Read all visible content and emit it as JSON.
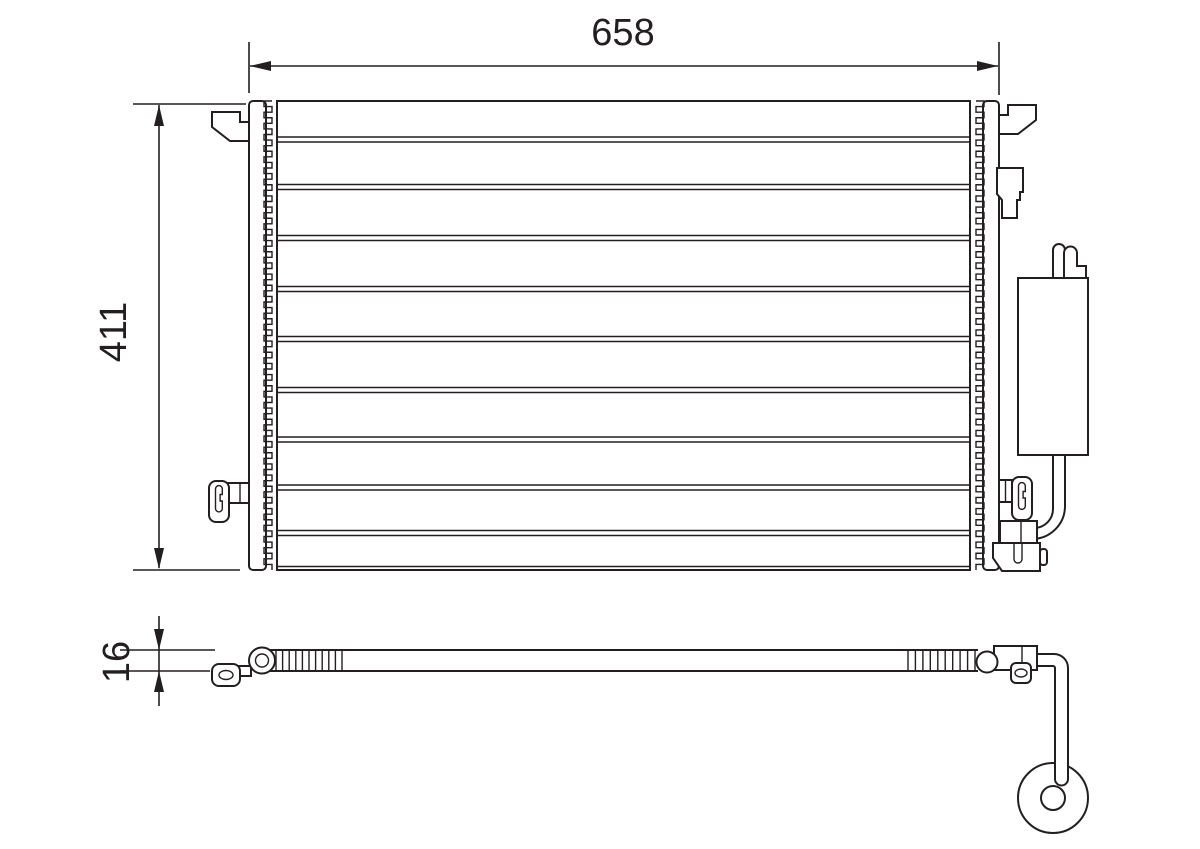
{
  "diagram": {
    "title": "condenser-technical-drawing",
    "background": "#ffffff",
    "ink": "#231f20",
    "dimensions": {
      "width_mm": "658",
      "height_mm": "411",
      "depth_mm": "16"
    },
    "core": {
      "x1": 277,
      "x2": 970,
      "tube_gap": 5,
      "tube_centers_y": [
        139.5,
        187,
        238,
        289,
        339,
        390,
        439.5,
        487.5,
        533
      ]
    },
    "fins": {
      "left": {
        "x_inner": 272,
        "x_outer": 264,
        "y1": 101,
        "y2": 570,
        "teeth": 42
      },
      "right": {
        "x_inner": 976,
        "x_outer": 984,
        "y1": 101,
        "y2": 570,
        "teeth": 42
      }
    },
    "side_ribs": {
      "left": {
        "x1": 276,
        "x2": 342,
        "count": 11,
        "y1": 650,
        "y2": 671
      },
      "right": {
        "x1": 908,
        "x2": 975,
        "count": 10,
        "y1": 650,
        "y2": 671
      }
    }
  }
}
